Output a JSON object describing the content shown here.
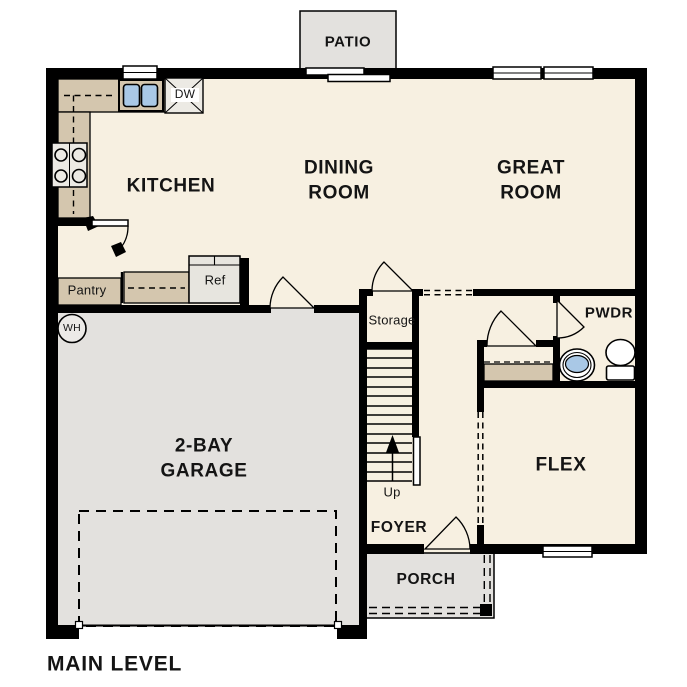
{
  "title": "MAIN LEVEL",
  "colors": {
    "floor": "#f7f0e1",
    "hard_surface": "#e3e1de",
    "counter": "#d4c6ae",
    "wall": "#000000",
    "water": "#a9c8e6",
    "appliance": "#eceae4",
    "background": "#ffffff"
  },
  "rooms": {
    "patio": "PATIO",
    "kitchen": "KITCHEN",
    "dining": "DINING\nROOM",
    "great": "GREAT\nROOM",
    "garage": "2-BAY\nGARAGE",
    "flex": "FLEX",
    "foyer": "FOYER",
    "porch": "PORCH",
    "pwdr": "PWDR",
    "storage": "Storage",
    "pantry": "Pantry"
  },
  "fixtures": {
    "ref": "Ref",
    "dw": "DW",
    "wh": "WH",
    "up": "Up"
  }
}
